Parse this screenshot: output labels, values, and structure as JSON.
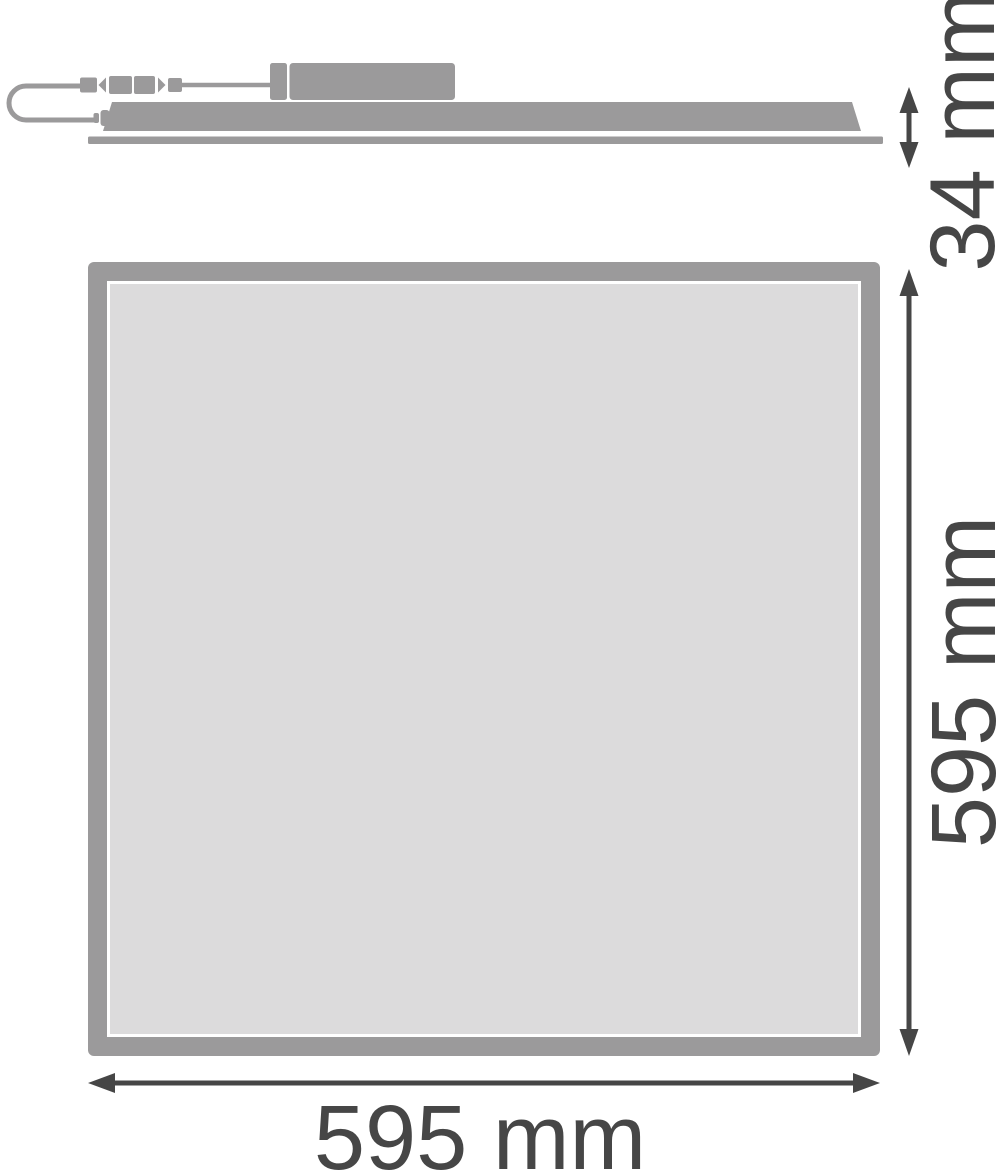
{
  "side_view": {
    "height_label": "34 mm"
  },
  "front_view": {
    "height_label": "595 mm",
    "width_label": "595 mm"
  },
  "colors": {
    "shape_gray": "#9b9a9b",
    "panel_fill": "#dcdbdc",
    "gap_white": "#ffffff",
    "dimension_color": "#464646"
  }
}
